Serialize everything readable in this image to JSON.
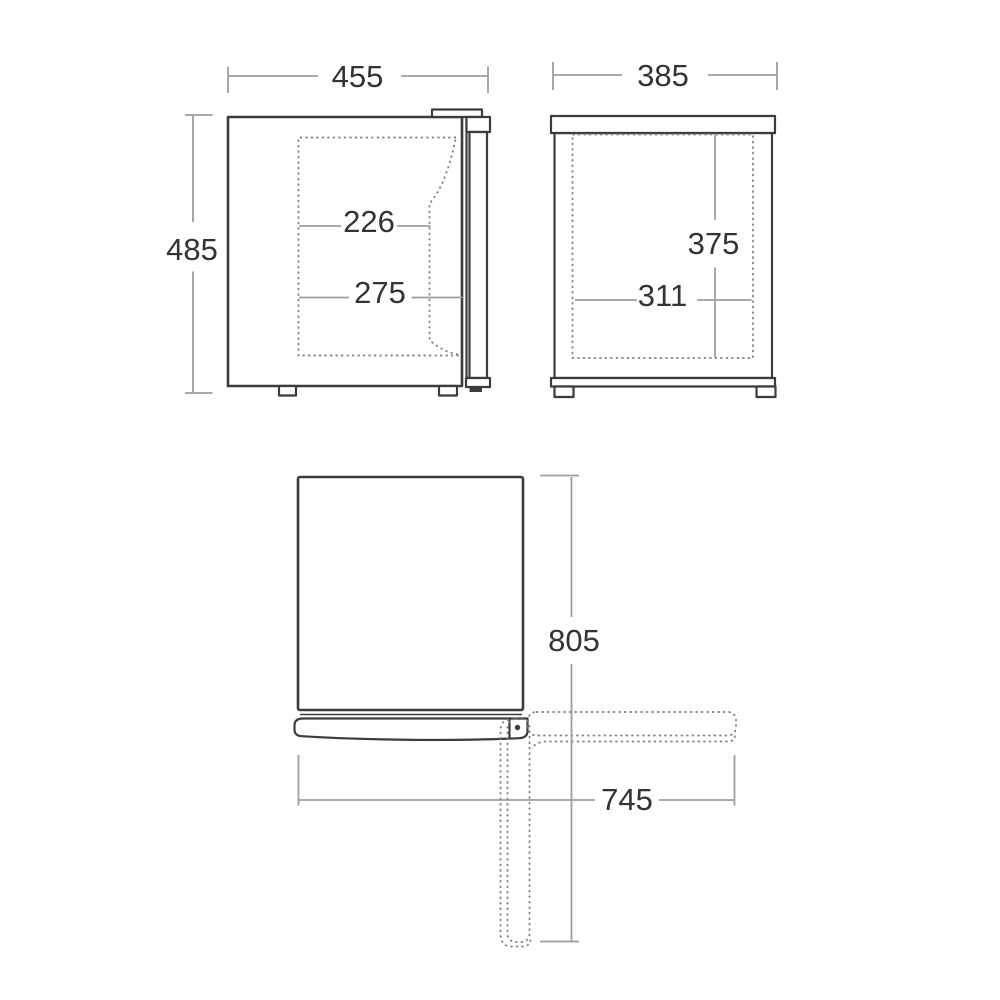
{
  "drawing": {
    "kind": "appliance dimension drawing",
    "unit_note": "",
    "colors": {
      "background": "#ffffff",
      "outline": "#3c3c3c",
      "dashed": "#7d7d7d",
      "dimension_line": "#9e9e9e",
      "dimension_text": "#333333"
    }
  },
  "views": {
    "front": {
      "overall_width": "455",
      "overall_height": "485",
      "inner_width_upper": "226",
      "inner_width_lower": "275"
    },
    "side": {
      "overall_depth": "385",
      "inner_height": "375",
      "inner_depth": "311"
    },
    "top": {
      "depth_door_open": "805",
      "width_door_open": "745"
    }
  }
}
